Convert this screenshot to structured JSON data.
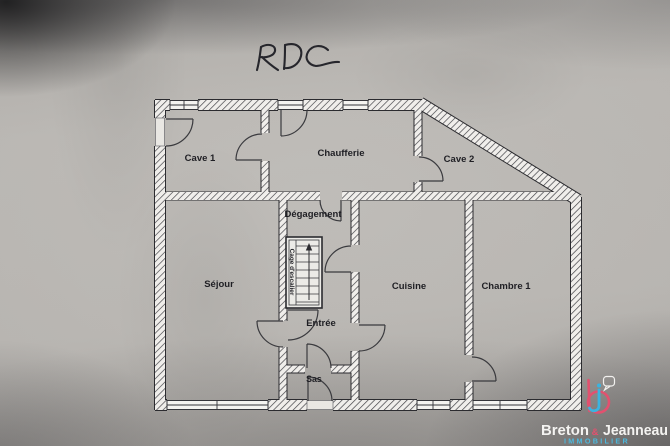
{
  "annotation": {
    "floor_label": "RDC"
  },
  "rooms": [
    {
      "name": "cave-1",
      "label": "Cave 1"
    },
    {
      "name": "chaufferie",
      "label": "Chaufferie"
    },
    {
      "name": "cave-2",
      "label": "Cave 2"
    },
    {
      "name": "degagement",
      "label": "Dégagement"
    },
    {
      "name": "sejour",
      "label": "Séjour"
    },
    {
      "name": "cuisine",
      "label": "Cuisine"
    },
    {
      "name": "chambre-1",
      "label": "Chambre 1"
    },
    {
      "name": "entree",
      "label": "Entrée"
    },
    {
      "name": "sas",
      "label": "Sas"
    },
    {
      "name": "cage-escalier",
      "label": "Cage d'escalier"
    }
  ],
  "watermark": {
    "brand_first": "Breton",
    "brand_ampersand": "&",
    "brand_second": "Jeanneau",
    "brand_tagline": "IMMOBILIER",
    "accent_pink": "#e2516f",
    "accent_blue": "#3ab4e0"
  }
}
